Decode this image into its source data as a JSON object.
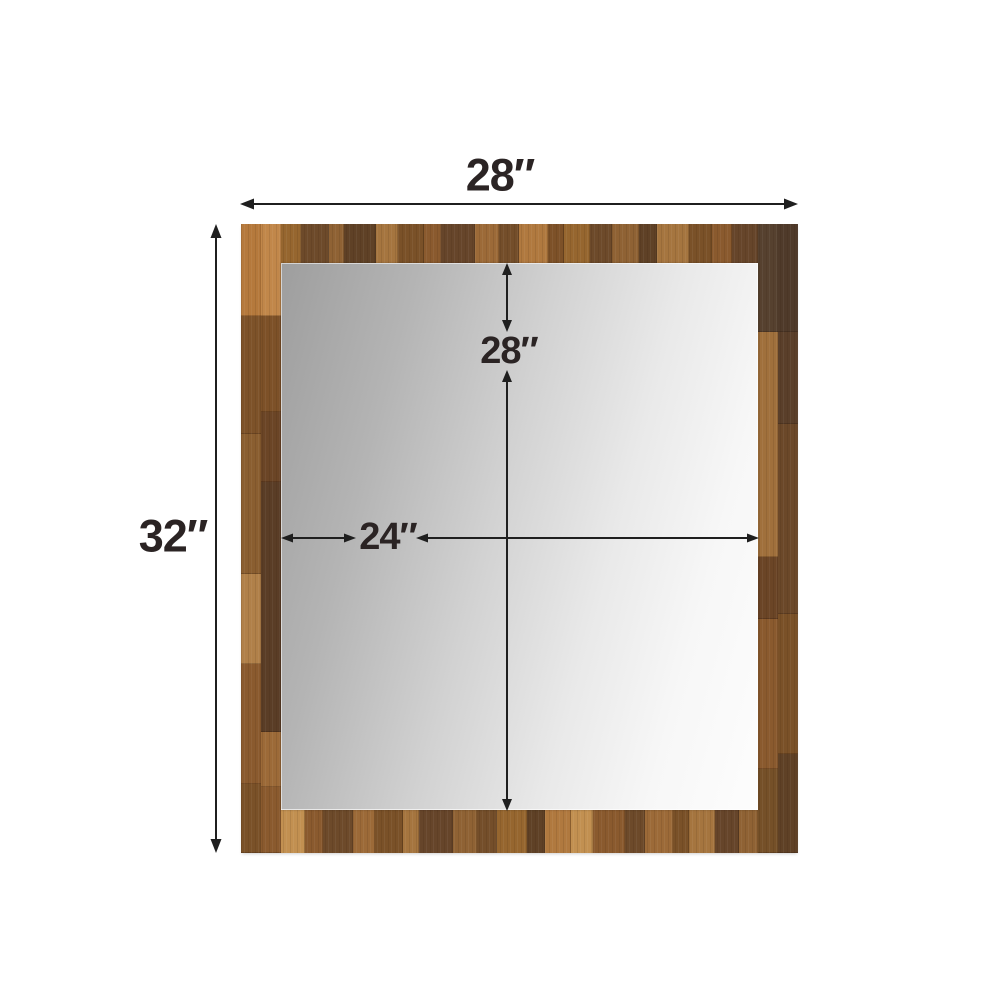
{
  "diagram": {
    "product": "framed-mirror-dimension-diagram",
    "dimensions": {
      "outer_width": "28″",
      "outer_height": "32″",
      "inner_height": "28″",
      "inner_width": "24″"
    },
    "colors": {
      "background": "#ffffff",
      "wood_light": "#b5793c",
      "wood_medium": "#8a5a2e",
      "wood_dark": "#5a3d26",
      "wood_corner_dark": "#4f3a2a",
      "mirror_gray": "#9e9e9e",
      "mirror_white": "#fdfdfd",
      "arrow_line": "#1f1f1f",
      "label_text": "#2b2424"
    }
  }
}
